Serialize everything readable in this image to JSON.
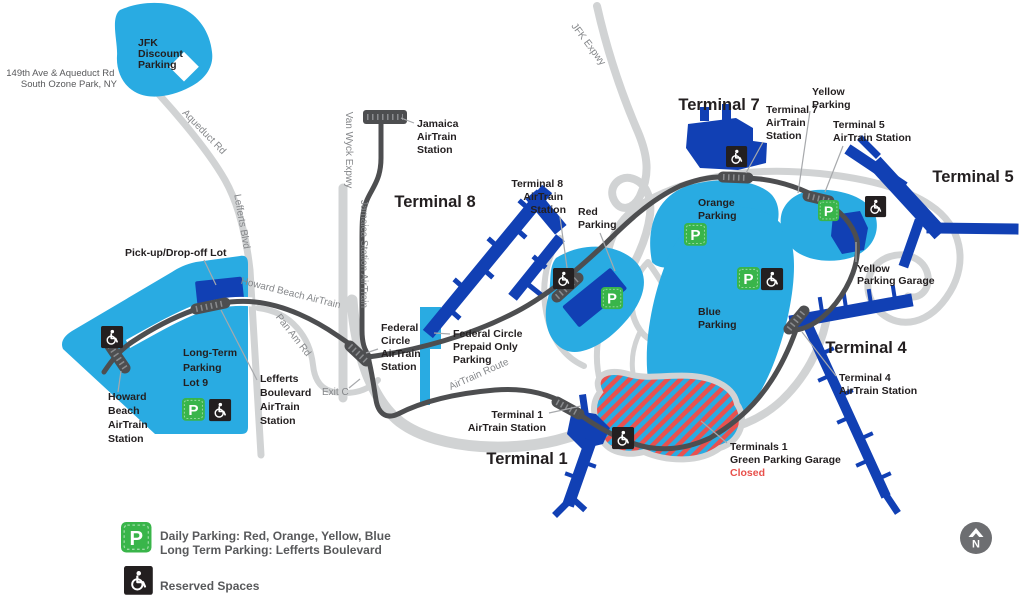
{
  "labels": {
    "jfk_discount": {
      "lines": [
        "JFK",
        "Discount",
        "Parking"
      ]
    },
    "address": {
      "lines": [
        "149th Ave & Aqueduct Rd",
        "South Ozone Park, NY"
      ]
    },
    "aqueduct_rd": "Aqueduct Rd",
    "lefferts_blvd": "Lefferts Blvd",
    "van_wyck": "Van Wyck Expwy",
    "jamaica_station_airtrain": "Jamaica Station AirTrain",
    "jfk_expwy": "JFK Expwy",
    "jamaica_station": {
      "lines": [
        "Jamaica",
        "AirTrain",
        "Station"
      ]
    },
    "terminal8": "Terminal 8",
    "terminal8_station": {
      "lines": [
        "Terminal 8",
        "AirTrain",
        "Station"
      ]
    },
    "red_parking": {
      "lines": [
        "Red",
        "Parking"
      ]
    },
    "terminal7": "Terminal 7",
    "yellow_parking": {
      "lines": [
        "Yellow",
        "Parking"
      ]
    },
    "terminal7_station": {
      "lines": [
        "Terminal 7",
        "AirTrain",
        "Station"
      ]
    },
    "terminal5_station": {
      "lines": [
        "Terminal 5",
        "AirTrain Station"
      ]
    },
    "orange_parking": {
      "lines": [
        "Orange",
        "Parking"
      ]
    },
    "terminal5": "Terminal 5",
    "yellow_garage": {
      "lines": [
        "Yellow",
        "Parking Garage"
      ]
    },
    "blue_parking": {
      "lines": [
        "Blue",
        "Parking"
      ]
    },
    "terminal4": "Terminal 4",
    "terminal4_station": {
      "lines": [
        "Terminal 4",
        "AirTrain Station"
      ]
    },
    "airtrain_route": "AirTrain Route",
    "howard_beach_airtrain": "Howard Beach AirTrain",
    "pan_am_rd": "Pan Am Rd",
    "exit_c": "Exit C",
    "federal_circle_station": {
      "lines": [
        "Federal",
        "Circle",
        "AirTrain",
        "Station"
      ]
    },
    "federal_prepaid": {
      "lines": [
        "Federal Circle",
        "Prepaid Only",
        "Parking"
      ]
    },
    "terminal1_station": {
      "lines": [
        "Terminal 1",
        "AirTrain Station"
      ]
    },
    "terminal1": "Terminal 1",
    "terminals1_green": {
      "lines": [
        "Terminals 1",
        "Green Parking Garage"
      ],
      "status": "Closed"
    },
    "pickup": "Pick-up/Drop-off Lot",
    "longterm": {
      "lines": [
        "Long-Term",
        "Parking",
        "Lot 9"
      ]
    },
    "lefferts_station": {
      "lines": [
        "Lefferts",
        "Boulevard",
        "AirTrain",
        "Station"
      ]
    },
    "howard_station": {
      "lines": [
        "Howard",
        "Beach",
        "AirTrain",
        "Station"
      ]
    }
  },
  "legend": {
    "daily": "Daily Parking: Red, Orange, Yellow, Blue",
    "long_term": "Long Term Parking: Lefferts Boulevard",
    "reserved": "Reserved Spaces"
  },
  "icons": {
    "parking_letter": "P",
    "compass_letter": "N"
  },
  "colors": {
    "parking_lot_blue": "#29abe2",
    "terminal_navy": "#1140b4",
    "road_gray": "#d1d3d4",
    "airtrain_gray": "#4d4e50",
    "parking_green": "#39b54a",
    "closed_red": "#e8504b"
  }
}
